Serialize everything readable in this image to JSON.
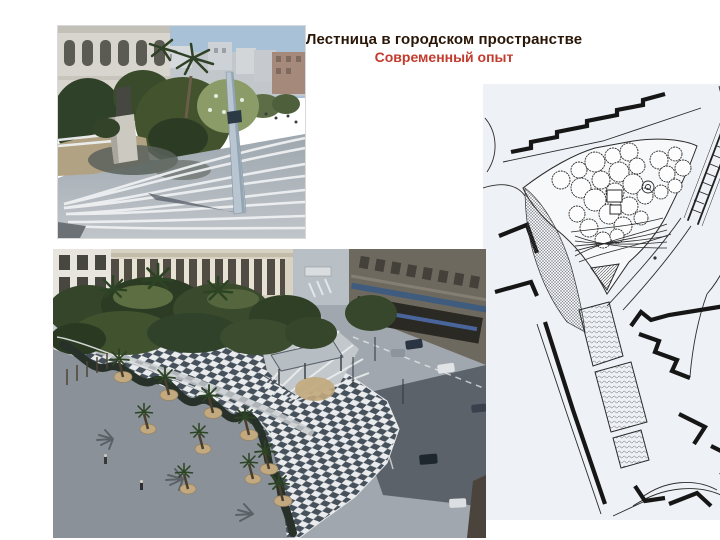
{
  "slide": {
    "title": "Лестница в городском пространстве",
    "subtitle": "Современный опыт"
  },
  "colors": {
    "background": "#ffffff",
    "title_text": "#2a1607",
    "subtitle_text": "#c23b2d"
  }
}
